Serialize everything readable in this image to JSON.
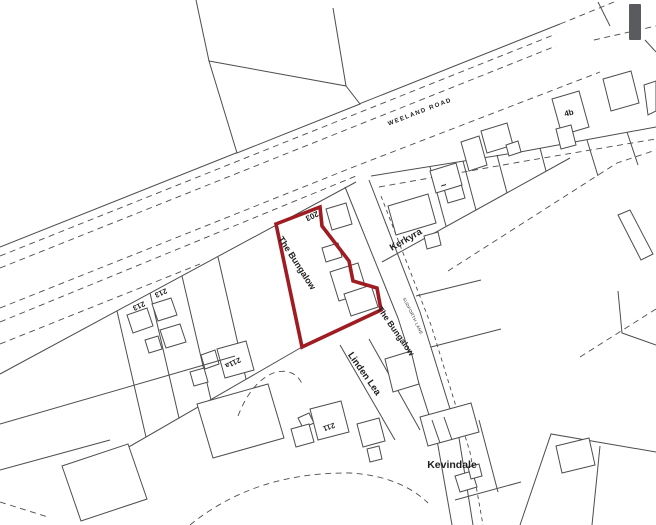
{
  "map": {
    "kind": "property site plan",
    "road_name": "WEELAND ROAD",
    "lane_name": "SUDFORTH LANE",
    "highlighted_property": "The Bungalow"
  },
  "colors": {
    "background": "#ffffff",
    "line": "#4d4d4d",
    "label": "#1f1f1f",
    "boundary_red": "#9e1c22",
    "scrollbar": "#595b5e"
  },
  "labels": [
    {
      "id": "road-weeland",
      "text": "WEELAND ROAD",
      "x": 420,
      "y": 112,
      "rotate": -21,
      "size": 6.2,
      "spacing": 1.4,
      "weight": "bold"
    },
    {
      "id": "plot-203",
      "text": "203",
      "x": 312,
      "y": 216,
      "rotate": 155,
      "size": 8,
      "weight": "bold"
    },
    {
      "id": "the-bungalow-west",
      "text": "The Bungalow",
      "x": 297,
      "y": 263,
      "rotate": 57,
      "size": 9,
      "weight": "bold"
    },
    {
      "id": "kerkyra",
      "text": "Kerkyra",
      "x": 406,
      "y": 240,
      "rotate": -30,
      "size": 9.5,
      "weight": "bold"
    },
    {
      "id": "plot-213-a",
      "text": "213",
      "x": 139,
      "y": 306,
      "rotate": 155,
      "size": 7.5,
      "weight": "bold"
    },
    {
      "id": "plot-213-b",
      "text": "213",
      "x": 161,
      "y": 293,
      "rotate": 155,
      "size": 7.5,
      "weight": "bold"
    },
    {
      "id": "plot-211a",
      "text": "211a",
      "x": 233,
      "y": 363,
      "rotate": 155,
      "size": 7.5,
      "weight": "bold"
    },
    {
      "id": "the-bungalow-east",
      "text": "The Bungalow",
      "x": 396,
      "y": 331,
      "rotate": 55,
      "size": 8.5,
      "weight": "bold"
    },
    {
      "id": "linden-lea",
      "text": "Linden Lea",
      "x": 364,
      "y": 374,
      "rotate": 55,
      "size": 9.5,
      "weight": "bold"
    },
    {
      "id": "plot-211",
      "text": "211",
      "x": 329,
      "y": 427,
      "rotate": 160,
      "size": 7.5,
      "weight": "bold"
    },
    {
      "id": "kevindale",
      "text": "Kevindale",
      "x": 452,
      "y": 465,
      "rotate": 0,
      "size": 10.5,
      "weight": "bold"
    },
    {
      "id": "plot-4b",
      "text": "4b",
      "x": 569,
      "y": 113,
      "rotate": -15,
      "size": 8,
      "weight": "bold"
    },
    {
      "id": "lane-name",
      "text": "SUDFORTH LANE",
      "x": 413,
      "y": 316,
      "rotate": 64,
      "size": 4.2,
      "spacing": 0.4,
      "weight": "normal"
    },
    {
      "id": "tilde-mark",
      "text": "~",
      "x": 444,
      "y": 186,
      "rotate": -25,
      "size": 10,
      "weight": "bold"
    }
  ]
}
